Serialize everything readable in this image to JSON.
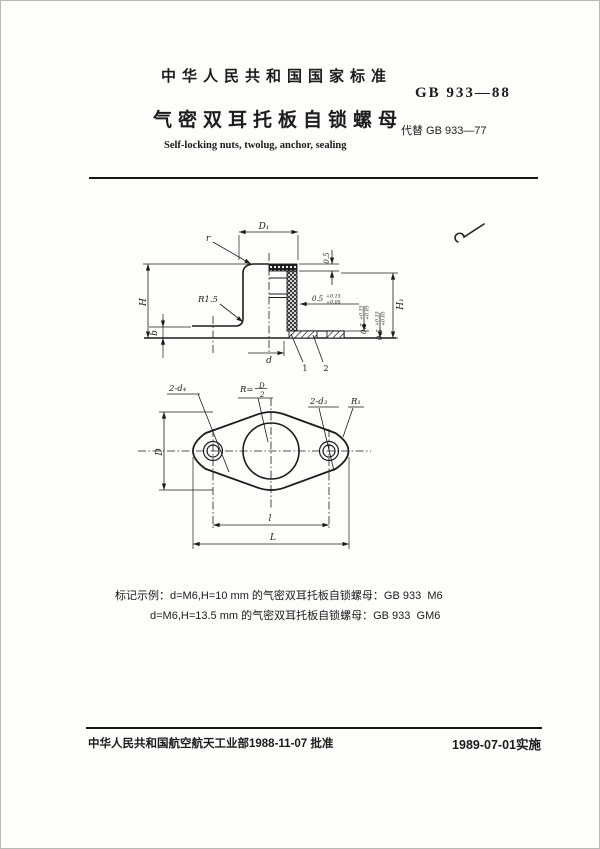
{
  "header": {
    "standard_label": "中华人民共和国国家标准",
    "standard_code": "GB 933—88",
    "title": "气密双耳托板自锁螺母",
    "replaces": "代替 GB 933—77",
    "title_en": "Self-locking nuts, twolug, anchor, sealing"
  },
  "drawing": {
    "section_view": {
      "dim_top_diameter": "D₁",
      "radius_top": "r",
      "radius_fillet": "R1.5",
      "dim_height": "H",
      "dim_base_thickness": "b",
      "dim_seal_height": "0.5",
      "tol_horizontal": {
        "base": "0.5",
        "sup": "+0.15",
        "sub": "+0.05"
      },
      "tol_vertical_1": {
        "base": "0.5",
        "sup": "+0.15",
        "sub": "+0.05"
      },
      "tol_vertical_2": {
        "base": "0.5",
        "sup": "+0.15",
        "sub": "+0.05"
      },
      "dim_total_height": "H₁",
      "dim_thread": "d",
      "part_1": "1",
      "part_2": "2"
    },
    "plan_view": {
      "holes_outer": "2-d₄",
      "radius_center_prefix": "R=",
      "radius_center_num": "D",
      "radius_center_den": "2",
      "holes_inner": "2-d₃",
      "radius_end": "R₁",
      "dim_width": "D",
      "dim_hole_spacing": "l",
      "dim_length": "L"
    }
  },
  "examples": {
    "line1": "标记示例：d=M6,H=10 mm 的气密双耳托板自锁螺母：GB 933  M6",
    "line2": "d=M6,H=13.5 mm 的气密双耳托板自锁螺母：GB 933  GM6"
  },
  "footer": {
    "approval": "中华人民共和国航空航天工业部1988-11-07 批准",
    "implementation": "1989-07-01实施"
  }
}
